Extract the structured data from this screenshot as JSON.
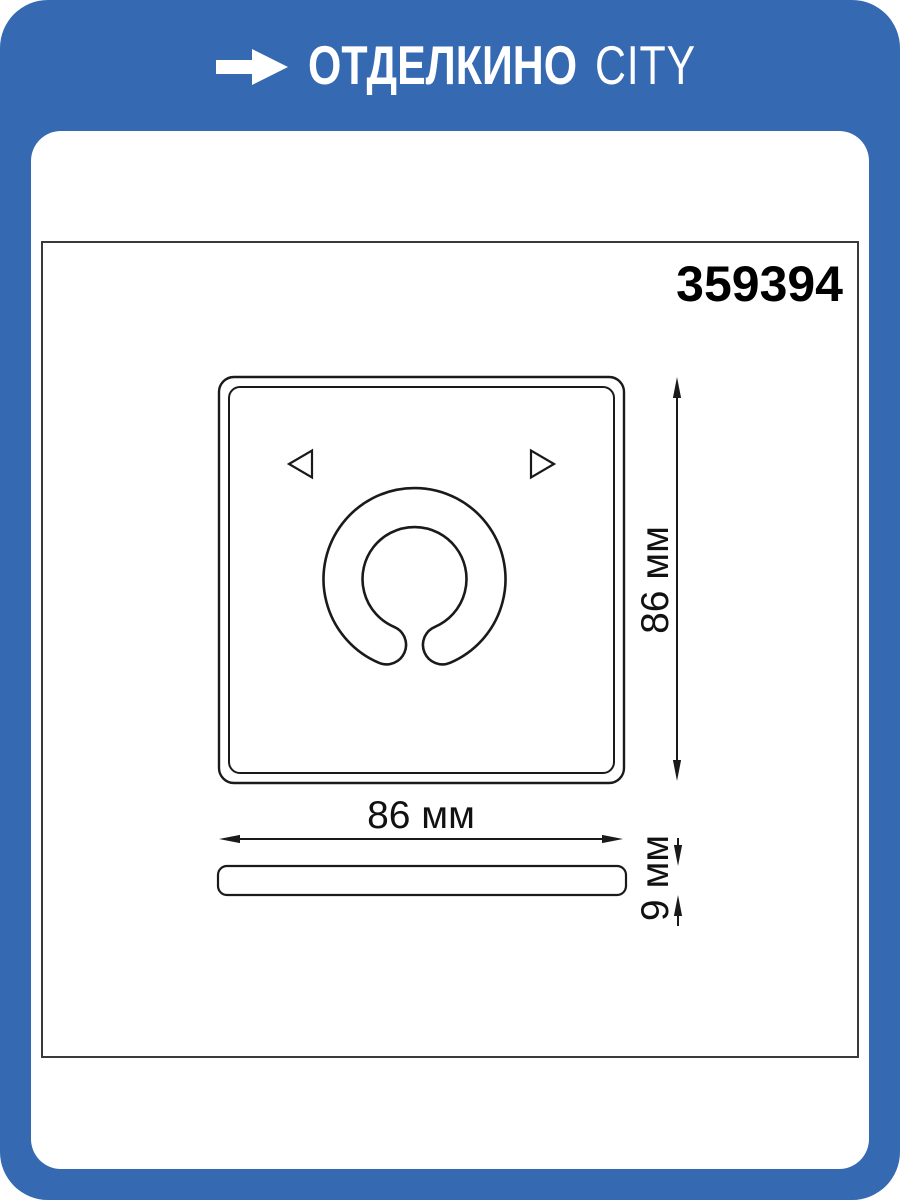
{
  "brand": {
    "logo_text_bold": "ОТДЕЛКИНО",
    "logo_text_light": "CITY",
    "banner_color": "#3569b1",
    "logo_color": "#ffffff"
  },
  "product": {
    "article_number": "359394"
  },
  "drawing": {
    "line_color": "#1a1a1a",
    "front_view": {
      "width_label": "86 мм",
      "height_label": "86 мм"
    },
    "side_view": {
      "depth_label": "9 мм"
    }
  }
}
